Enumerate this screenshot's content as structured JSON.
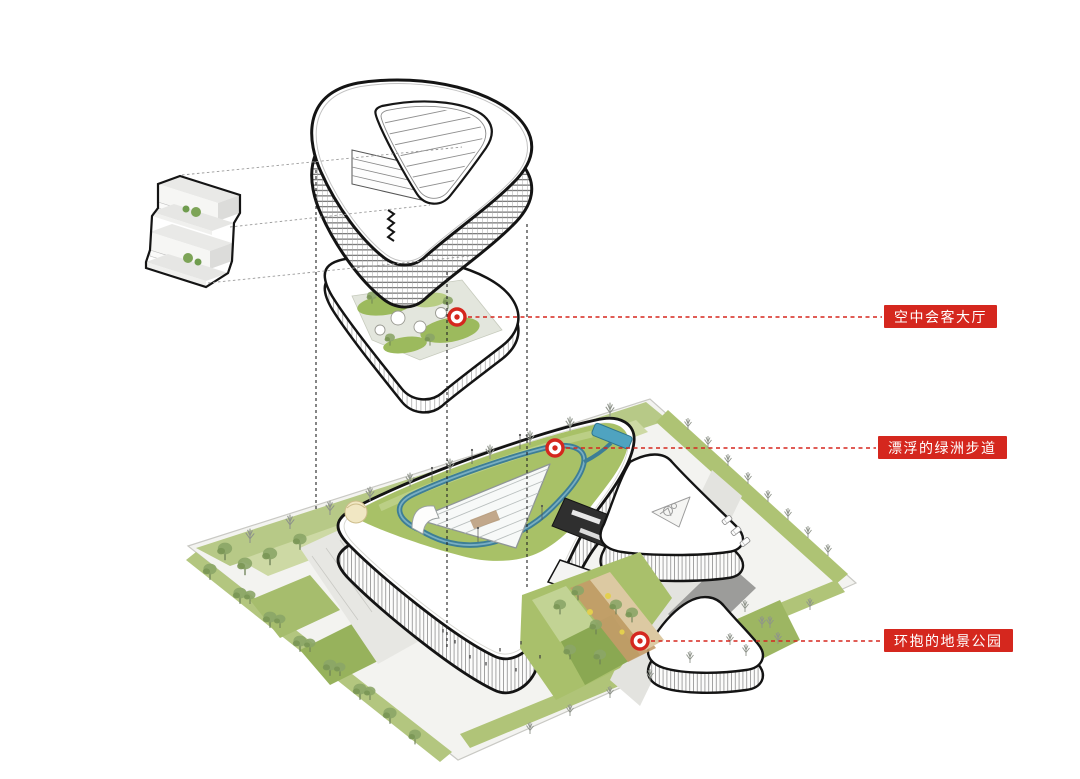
{
  "diagram": {
    "kind": "architectural-axonometric-exploded-diagram",
    "background": "#ffffff",
    "parts": [
      "tower-volume",
      "floor-plate-detail",
      "sky-deck",
      "site-plan"
    ]
  },
  "callouts": [
    {
      "id": "sky-lounge",
      "label": "空中会客大厅",
      "marker": {
        "x": 457,
        "y": 317
      },
      "label_left": 884
    },
    {
      "id": "oasis-walkway",
      "label": "漂浮的绿洲步道",
      "marker": {
        "x": 555,
        "y": 448
      },
      "label_left": 878
    },
    {
      "id": "landscape-park",
      "label": "环抱的地景公园",
      "marker": {
        "x": 640,
        "y": 641
      },
      "label_left": 884
    }
  ],
  "colors": {
    "callout_red": "#d5271e",
    "outline_black": "#141414",
    "lawn_green": "#adc372",
    "lawn_green_light": "#c6d59c",
    "roof_garden_green": "#a8c167",
    "walkway_teal": "#3d7e96",
    "pool_blue": "#4fa3c0",
    "path_tan": "#c39b68",
    "accent_yellow": "#e3cf4e",
    "ground_gray": "#f3f3f0"
  }
}
